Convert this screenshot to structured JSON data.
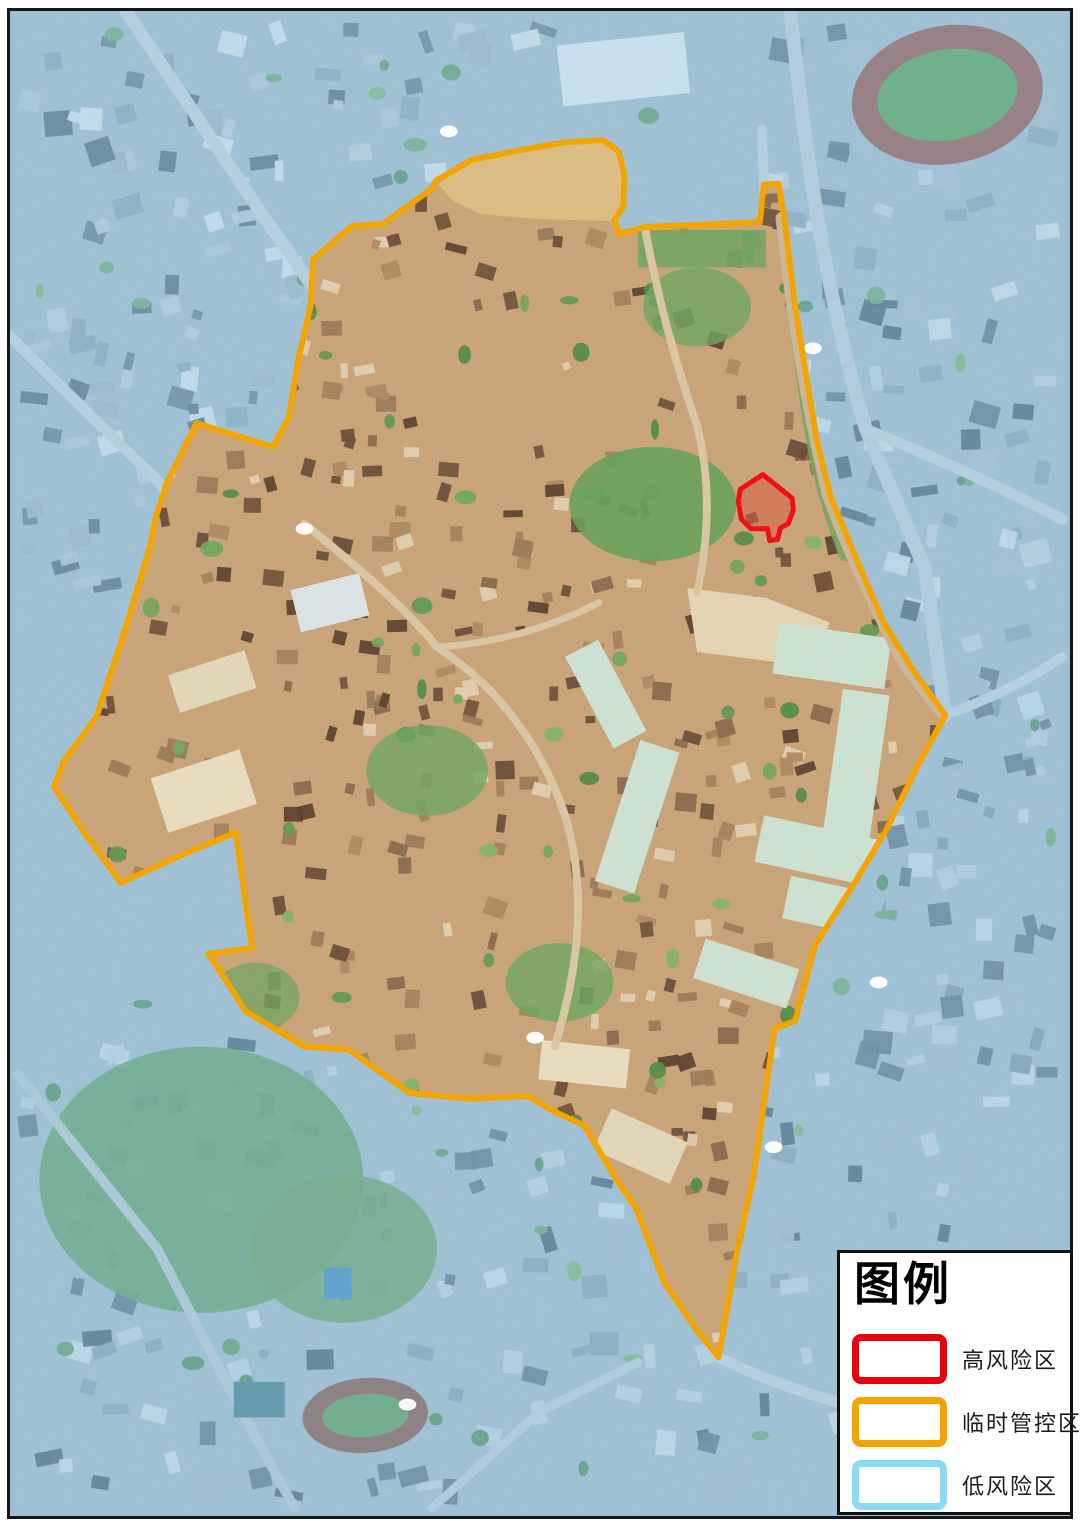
{
  "legend": {
    "title": "图例",
    "items": [
      {
        "id": "high-risk",
        "label": "高风险区",
        "color": "#e8000d"
      },
      {
        "id": "temp-control",
        "label": "临时管控区",
        "color": "#f2a400"
      },
      {
        "id": "low-risk",
        "label": "低风险区",
        "color": "#8cd9f5"
      }
    ]
  },
  "map": {
    "palette": {
      "outside_base": "#a7bdcb",
      "inside_base": "#c9a478",
      "road_outside": "#c9d5dc",
      "road_inside": "#d9c6a5"
    },
    "zones": {
      "temporary_control_zone": {
        "label": "临时管控区",
        "stroke": "#f2a400",
        "stroke_width": 6,
        "boundary": [
          [
            45,
            787
          ],
          [
            55,
            760
          ],
          [
            88,
            716
          ],
          [
            118,
            625
          ],
          [
            143,
            542
          ],
          [
            148,
            515
          ],
          [
            160,
            478
          ],
          [
            190,
            418
          ],
          [
            268,
            442
          ],
          [
            284,
            412
          ],
          [
            294,
            352
          ],
          [
            306,
            300
          ],
          [
            309,
            252
          ],
          [
            348,
            218
          ],
          [
            380,
            216
          ],
          [
            430,
            180
          ],
          [
            434,
            172
          ],
          [
            470,
            151
          ],
          [
            520,
            141
          ],
          [
            566,
            133
          ],
          [
            604,
            131
          ],
          [
            620,
            142
          ],
          [
            626,
            166
          ],
          [
            625,
            198
          ],
          [
            616,
            212
          ],
          [
            621,
            226
          ],
          [
            647,
            219
          ],
          [
            700,
            217
          ],
          [
            764,
            214
          ],
          [
            768,
            176
          ],
          [
            783,
            175
          ],
          [
            789,
            210
          ],
          [
            800,
            300
          ],
          [
            812,
            375
          ],
          [
            822,
            435
          ],
          [
            836,
            492
          ],
          [
            860,
            550
          ],
          [
            890,
            620
          ],
          [
            920,
            668
          ],
          [
            953,
            714
          ],
          [
            925,
            765
          ],
          [
            893,
            830
          ],
          [
            860,
            885
          ],
          [
            820,
            948
          ],
          [
            800,
            1024
          ],
          [
            779,
            1032
          ],
          [
            758,
            1180
          ],
          [
            740,
            1262
          ],
          [
            722,
            1365
          ],
          [
            700,
            1338
          ],
          [
            667,
            1290
          ],
          [
            638,
            1214
          ],
          [
            618,
            1185
          ],
          [
            585,
            1130
          ],
          [
            555,
            1116
          ],
          [
            527,
            1100
          ],
          [
            470,
            1103
          ],
          [
            407,
            1097
          ],
          [
            345,
            1053
          ],
          [
            300,
            1050
          ],
          [
            268,
            1031
          ],
          [
            240,
            1014
          ],
          [
            207,
            963
          ],
          [
            202,
            956
          ],
          [
            247,
            950
          ],
          [
            242,
            918
          ],
          [
            230,
            833
          ],
          [
            172,
            857
          ],
          [
            113,
            884
          ],
          [
            75,
            832
          ]
        ]
      },
      "high_risk_zone": {
        "label": "高风险区",
        "stroke": "#ee1111",
        "stroke_width": 5,
        "fill": "#e03020",
        "fill_opacity": 0.33,
        "boundary": [
          [
            742,
            497
          ],
          [
            744,
            485
          ],
          [
            767,
            470
          ],
          [
            797,
            494
          ],
          [
            798,
            506
          ],
          [
            793,
            520
          ],
          [
            785,
            524
          ],
          [
            782,
            536
          ],
          [
            774,
            537
          ],
          [
            772,
            525
          ],
          [
            755,
            525
          ],
          [
            745,
            515
          ]
        ]
      },
      "low_risk_zone": {
        "label": "低风险区",
        "overlay_color": "#96c7e6",
        "overlay_opacity": 0.38
      }
    },
    "markers": [
      [
        447,
        122
      ],
      [
        818,
        342
      ],
      [
        300,
        525
      ],
      [
        535,
        1041
      ],
      [
        885,
        985
      ],
      [
        778,
        1152
      ],
      [
        405,
        1413
      ]
    ],
    "features": [
      {
        "layer": "outside",
        "type": "scatter",
        "name": "city-blocks-northwest",
        "region": [
          8,
          8,
          560,
          580
        ],
        "count": 150,
        "seed": 11,
        "min": 8,
        "max": 30,
        "colors": [
          "#dde8ee",
          "#b7c8d3",
          "#64798a",
          "#8da3b3",
          "#52687a",
          "#c2cfd8",
          "#9fb3c0"
        ]
      },
      {
        "layer": "outside",
        "type": "scatter",
        "name": "city-blocks-northeast",
        "region": [
          770,
          8,
          302,
          650
        ],
        "count": 95,
        "seed": 22,
        "min": 8,
        "max": 30,
        "colors": [
          "#d8e3ea",
          "#aebfcb",
          "#5d7384",
          "#8da3b3",
          "#49606f",
          "#c6d4dd"
        ]
      },
      {
        "layer": "outside",
        "type": "scatter",
        "name": "city-blocks-east",
        "region": [
          880,
          660,
          192,
          430
        ],
        "count": 55,
        "seed": 33,
        "min": 8,
        "max": 28,
        "colors": [
          "#cfdde6",
          "#a9bcc9",
          "#5d7384",
          "#8096a6",
          "#c2d1da"
        ]
      },
      {
        "layer": "outside",
        "type": "scatter",
        "name": "city-blocks-south",
        "region": [
          8,
          1030,
          1064,
          488
        ],
        "count": 170,
        "seed": 44,
        "min": 8,
        "max": 30,
        "colors": [
          "#d3e0e8",
          "#a9bcc9",
          "#5d7384",
          "#8aa0b0",
          "#47606e",
          "#c7d6de"
        ]
      },
      {
        "layer": "outside",
        "type": "scatter",
        "name": "trees-outside",
        "region": [
          8,
          8,
          1064,
          1510
        ],
        "count": 80,
        "seed": 55,
        "min": 8,
        "max": 24,
        "shape": "ellipse",
        "colors": [
          "#6fa96b",
          "#5c9a5f",
          "#7db573",
          "#4f8d55"
        ]
      },
      {
        "layer": "outside",
        "type": "ellipse",
        "name": "wooded-hill",
        "cx": 195,
        "cy": 1185,
        "rx": 165,
        "ry": 135,
        "fill": "#5f9f63",
        "opacity": 0.9
      },
      {
        "layer": "outside",
        "type": "ellipse",
        "name": "wooded-hill",
        "cx": 340,
        "cy": 1255,
        "rx": 95,
        "ry": 75,
        "fill": "#679f5d",
        "opacity": 0.85
      },
      {
        "layer": "outside",
        "type": "path",
        "name": "road",
        "d": "M118,0 L258,208 L330,310 L300,525 L240,610",
        "stroke": "#c9d5dc",
        "width": 13
      },
      {
        "layer": "outside",
        "type": "path",
        "name": "road",
        "d": "M0,330 L152,478 L240,608 L190,730",
        "stroke": "#c9d5dc",
        "width": 11
      },
      {
        "layer": "outside",
        "type": "path",
        "name": "road",
        "d": "M795,0 C815,190 838,310 872,424 L932,565 L953,714",
        "stroke": "#c3d0d8",
        "width": 14
      },
      {
        "layer": "outside",
        "type": "path",
        "name": "road",
        "d": "M872,424 Q985,470 1072,515",
        "stroke": "#c9d5dc",
        "width": 11
      },
      {
        "layer": "outside",
        "type": "path",
        "name": "road",
        "d": "M953,714 Q1020,690 1072,655",
        "stroke": "#c9d5dc",
        "width": 10
      },
      {
        "layer": "outside",
        "type": "path",
        "name": "road",
        "d": "M722,1365 Q810,1408 910,1425 L1072,1442",
        "stroke": "#c9d5dc",
        "width": 11
      },
      {
        "layer": "outside",
        "type": "path",
        "name": "road",
        "d": "M8,1078 L150,1255 L236,1420 L290,1518",
        "stroke": "#bcc9d2",
        "width": 10
      },
      {
        "layer": "outside",
        "type": "path",
        "name": "road",
        "d": "M430,1518 L540,1420 L640,1370",
        "stroke": "#c2cfd8",
        "width": 9
      },
      {
        "layer": "outside",
        "type": "path",
        "name": "road",
        "d": "M766,120 L770,215",
        "stroke": "#c9d5dc",
        "width": 10
      },
      {
        "layer": "outside",
        "type": "rect",
        "name": "large-white-building",
        "x": 560,
        "y": 28,
        "w": 130,
        "h": 62,
        "rot": -6,
        "fill": "#e8eff3"
      },
      {
        "layer": "outside",
        "type": "ellipse",
        "name": "stadium-track",
        "cx": 955,
        "cy": 85,
        "rx": 98,
        "ry": 70,
        "rot": -10,
        "fill": "#96564c"
      },
      {
        "layer": "outside",
        "type": "ellipse",
        "name": "stadium-field",
        "cx": 955,
        "cy": 85,
        "rx": 72,
        "ry": 46,
        "rot": -10,
        "fill": "#58a355"
      },
      {
        "layer": "outside",
        "type": "ellipse",
        "name": "school-track",
        "cx": 362,
        "cy": 1424,
        "rx": 64,
        "ry": 38,
        "rot": -4,
        "fill": "#8a564a"
      },
      {
        "layer": "outside",
        "type": "ellipse",
        "name": "school-field",
        "cx": 362,
        "cy": 1424,
        "rx": 44,
        "ry": 22,
        "rot": -4,
        "fill": "#5da05a"
      },
      {
        "layer": "outside",
        "type": "rect",
        "name": "basketball-courts",
        "x": 228,
        "y": 1390,
        "w": 52,
        "h": 36,
        "fill": "#44808c"
      },
      {
        "layer": "outside",
        "type": "rect",
        "name": "swimming-pool",
        "x": 320,
        "y": 1274,
        "w": 28,
        "h": 32,
        "fill": "#3e8fc0"
      },
      {
        "layer": "inside",
        "type": "scatter",
        "name": "village-buildings",
        "region": [
          60,
          140,
          900,
          1240
        ],
        "count": 520,
        "seed": 77,
        "min": 7,
        "max": 22,
        "colors": [
          "#8a6a4e",
          "#73543c",
          "#9c7a58",
          "#6b4f3a",
          "#b08a60",
          "#e0d0b2",
          "#5e4430",
          "#a5825c"
        ]
      },
      {
        "layer": "inside",
        "type": "scatter",
        "name": "village-trees",
        "region": [
          60,
          140,
          900,
          1240
        ],
        "count": 110,
        "seed": 88,
        "min": 8,
        "max": 24,
        "shape": "ellipse",
        "colors": [
          "#74a65c",
          "#629a52",
          "#86b368",
          "#558c49"
        ]
      },
      {
        "layer": "inside",
        "type": "ellipse",
        "name": "village-green-hill",
        "cx": 655,
        "cy": 500,
        "rx": 85,
        "ry": 58,
        "fill": "#67a257",
        "opacity": 0.9
      },
      {
        "layer": "inside",
        "type": "ellipse",
        "name": "village-green",
        "cx": 425,
        "cy": 770,
        "rx": 62,
        "ry": 46,
        "fill": "#6fa65f",
        "opacity": 0.8
      },
      {
        "layer": "inside",
        "type": "ellipse",
        "name": "village-green",
        "cx": 560,
        "cy": 985,
        "rx": 55,
        "ry": 40,
        "fill": "#6fa65f",
        "opacity": 0.8
      },
      {
        "layer": "inside",
        "type": "ellipse",
        "name": "village-green",
        "cx": 250,
        "cy": 1000,
        "rx": 45,
        "ry": 35,
        "fill": "#6fa65f",
        "opacity": 0.75
      },
      {
        "layer": "inside",
        "type": "ellipse",
        "name": "village-green",
        "cx": 700,
        "cy": 300,
        "rx": 55,
        "ry": 40,
        "fill": "#6fa65f",
        "opacity": 0.8
      },
      {
        "layer": "inside",
        "type": "rect",
        "name": "tree-row",
        "x": 640,
        "y": 222,
        "w": 130,
        "h": 38,
        "fill": "#6fa65f",
        "opacity": 0.85
      },
      {
        "layer": "inside",
        "type": "path",
        "name": "tree-line",
        "d": "M792,230 Q806,360 820,440 Q832,500 852,550",
        "stroke": "#6fa65f",
        "width": 16,
        "opacity": 0.8
      },
      {
        "layer": "inside",
        "type": "polygon",
        "name": "construction-site",
        "points": [
          [
            436,
            176
          ],
          [
            470,
            151
          ],
          [
            520,
            142
          ],
          [
            566,
            134
          ],
          [
            604,
            133
          ],
          [
            620,
            143
          ],
          [
            626,
            166
          ],
          [
            625,
            198
          ],
          [
            616,
            213
          ],
          [
            540,
            211
          ],
          [
            480,
            206
          ],
          [
            452,
            193
          ]
        ],
        "fill": "#dcbc82"
      },
      {
        "layer": "inside",
        "type": "polygon",
        "name": "market-plaza",
        "points": [
          [
            690,
            585
          ],
          [
            770,
            595
          ],
          [
            835,
            620
          ],
          [
            820,
            665
          ],
          [
            700,
            650
          ]
        ],
        "fill": "#e3d5b5"
      },
      {
        "layer": "inside",
        "type": "rect",
        "name": "market-hall",
        "x": 780,
        "y": 628,
        "w": 115,
        "h": 52,
        "rot": 8,
        "fill": "#cde2d2"
      },
      {
        "layer": "inside",
        "type": "rect",
        "name": "market-hall",
        "x": 838,
        "y": 690,
        "w": 48,
        "h": 150,
        "rot": 8,
        "fill": "#cde2d2"
      },
      {
        "layer": "inside",
        "type": "rect",
        "name": "market-hall",
        "x": 762,
        "y": 828,
        "w": 125,
        "h": 48,
        "rot": 12,
        "fill": "#cde2d2"
      },
      {
        "layer": "inside",
        "type": "rect",
        "name": "market-hall",
        "x": 790,
        "y": 888,
        "w": 112,
        "h": 44,
        "rot": 12,
        "fill": "#cde2d2"
      },
      {
        "layer": "inside",
        "type": "rect",
        "name": "market-hall",
        "x": 618,
        "y": 742,
        "w": 42,
        "h": 150,
        "rot": 18,
        "fill": "#cde2d2"
      },
      {
        "layer": "inside",
        "type": "rect",
        "name": "market-hall",
        "x": 588,
        "y": 640,
        "w": 38,
        "h": 105,
        "rot": -28,
        "fill": "#cde2d2"
      },
      {
        "layer": "inside",
        "type": "rect",
        "name": "market-hall",
        "x": 700,
        "y": 955,
        "w": 100,
        "h": 42,
        "rot": 18,
        "fill": "#cde2d2"
      },
      {
        "layer": "inside",
        "type": "rect",
        "name": "warehouse",
        "x": 150,
        "y": 762,
        "w": 95,
        "h": 58,
        "rot": -18,
        "fill": "#e9ddc0"
      },
      {
        "layer": "inside",
        "type": "rect",
        "name": "warehouse",
        "x": 165,
        "y": 660,
        "w": 82,
        "h": 40,
        "rot": -18,
        "fill": "#e2d6ba"
      },
      {
        "layer": "inside",
        "type": "rect",
        "name": "warehouse",
        "x": 290,
        "y": 578,
        "w": 72,
        "h": 44,
        "rot": -14,
        "fill": "#dbe4e6"
      },
      {
        "layer": "inside",
        "type": "rect",
        "name": "warehouse",
        "x": 540,
        "y": 1048,
        "w": 90,
        "h": 40,
        "rot": 6,
        "fill": "#e9ddc0"
      },
      {
        "layer": "inside",
        "type": "rect",
        "name": "warehouse",
        "x": 600,
        "y": 1128,
        "w": 85,
        "h": 46,
        "rot": 24,
        "fill": "#e2d6ba"
      },
      {
        "layer": "inside",
        "type": "path",
        "name": "village-road",
        "d": "M300,520 Q400,600 435,645 Q520,700 560,800 Q600,905 555,1050",
        "stroke": "#d9c6a5",
        "width": 8
      },
      {
        "layer": "inside",
        "type": "path",
        "name": "village-road",
        "d": "M647,220 Q665,320 700,420 Q720,500 700,590",
        "stroke": "#d9c6a5",
        "width": 8
      },
      {
        "layer": "inside",
        "type": "path",
        "name": "village-road",
        "d": "M435,645 Q520,640 600,600",
        "stroke": "#d9c6a5",
        "width": 7
      },
      {
        "layer": "inside",
        "type": "path",
        "name": "ring-road",
        "d": "M786,210 Q802,360 833,490 Q862,570 912,664 L950,712",
        "stroke": "#cdb697",
        "width": 12
      }
    ]
  }
}
